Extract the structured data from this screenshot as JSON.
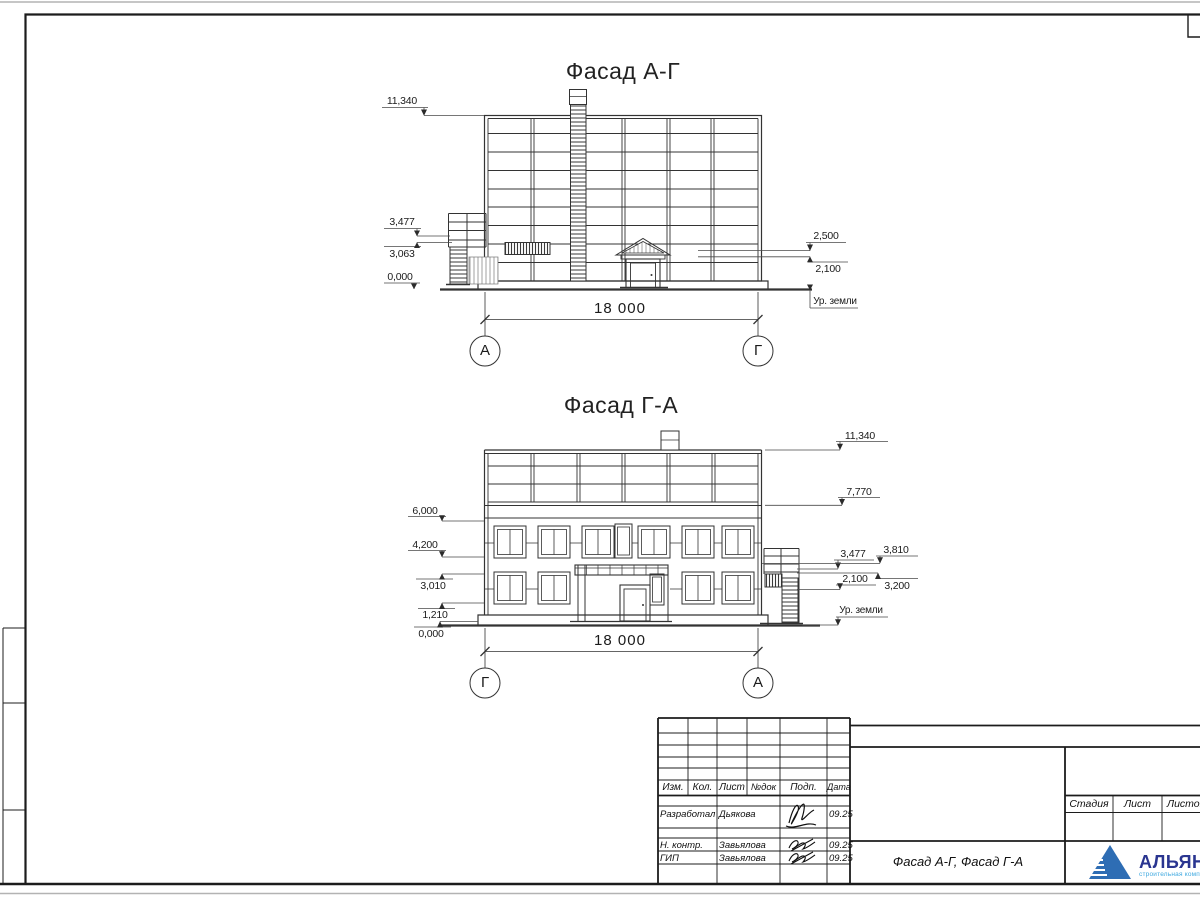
{
  "sheet": {
    "facade_top": {
      "title": "Фасад А-Г",
      "marks_left": [
        "11,340",
        "3,477",
        "3,063",
        "0,000"
      ],
      "marks_right": [
        "2,500",
        "2,100"
      ],
      "ground_label": "Ур. земли",
      "total_dim": "18 000",
      "axis_left": "А",
      "axis_right": "Г"
    },
    "facade_bottom": {
      "title": "Фасад Г-А",
      "marks_left": [
        "6,000",
        "4,200",
        "3,010",
        "1,210",
        "0,000"
      ],
      "marks_right": [
        "11,340",
        "7,770",
        "3,477",
        "3,810",
        "2,100",
        "3,200"
      ],
      "ground_label": "Ур. земли",
      "total_dim": "18 000",
      "axis_left": "Г",
      "axis_right": "А"
    },
    "titleblock": {
      "rev_cols": [
        "Изм.",
        "Кол.",
        "Лист",
        "№док",
        "Подп.",
        "Дата"
      ],
      "staff": [
        {
          "role": "Разработал",
          "name": "Дьякова",
          "date": "09.25"
        },
        {
          "role": "Н. контр.",
          "name": "Завьялова",
          "date": "09.25"
        },
        {
          "role": "ГИП",
          "name": "Завьялова",
          "date": "09.25"
        }
      ],
      "doc_title": "Фасад А-Г, Фасад Г-А",
      "stage_cols": [
        "Стадия",
        "Лист",
        "Листов"
      ],
      "company": {
        "name": "АЛЬЯНС",
        "tagline": "строительная компания"
      },
      "colors": {
        "logo_triangle": "#2e6db4",
        "logo_name": "#2a3590",
        "logo_tagline": "#3fa9e0",
        "line": "#333333"
      }
    }
  }
}
